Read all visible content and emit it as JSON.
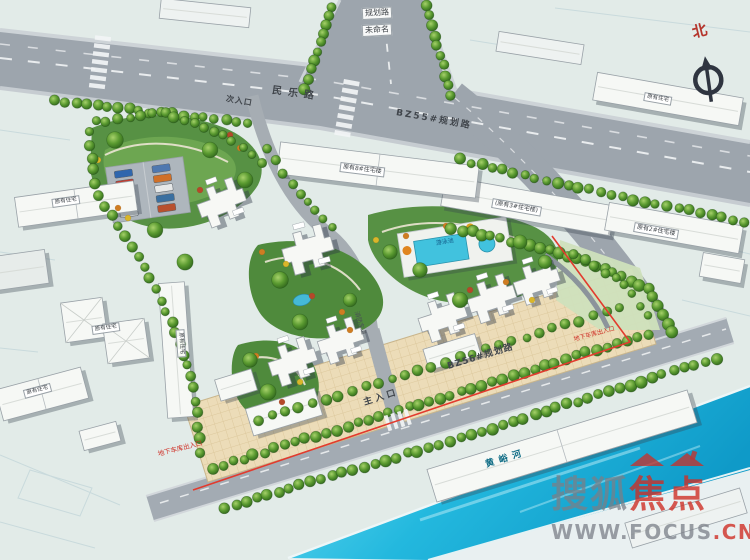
{
  "compass": {
    "north_label": "北"
  },
  "roads": {
    "branch_top_line1": "规划路",
    "branch_top_line2": "未命名",
    "minle": "民乐路",
    "bz55": "BZ55#规划路",
    "bz56": "BZ56#规划路",
    "fire_lane": "消防车道"
  },
  "entrances": {
    "main": "主入口",
    "secondary": "次入口",
    "garage_sw": "地下车库出入口",
    "garage_e": "地下车库出入口"
  },
  "buildings": {
    "north_slab": "原有8#住宅楼",
    "northeast_slab": "(原有3#住宅楼)",
    "east_slab": "原有2#住宅楼",
    "existing_w1": "原有住宅",
    "existing_w2": "原有住宅",
    "existing_w3": "原有住宅",
    "existing_w4": "原有住宅",
    "existing_ne": "原有住宅"
  },
  "amenities": {
    "pool": "游泳池"
  },
  "water": {
    "river": "黄峪河"
  },
  "watermark": {
    "brand_gray": "搜狐",
    "brand_red": "焦点",
    "url_main": "WWW.FOCUS",
    "url_suffix": ".CN"
  },
  "colors": {
    "road": "#9da5ad",
    "river": "#2ec3e8",
    "plaza": "#ecdcb8",
    "tree": "#3f7d2b",
    "boundary_red": "#e23b2e",
    "watermark_red": "#d0302a",
    "watermark_gray": "#80858d",
    "north_red": "#b5352c"
  }
}
